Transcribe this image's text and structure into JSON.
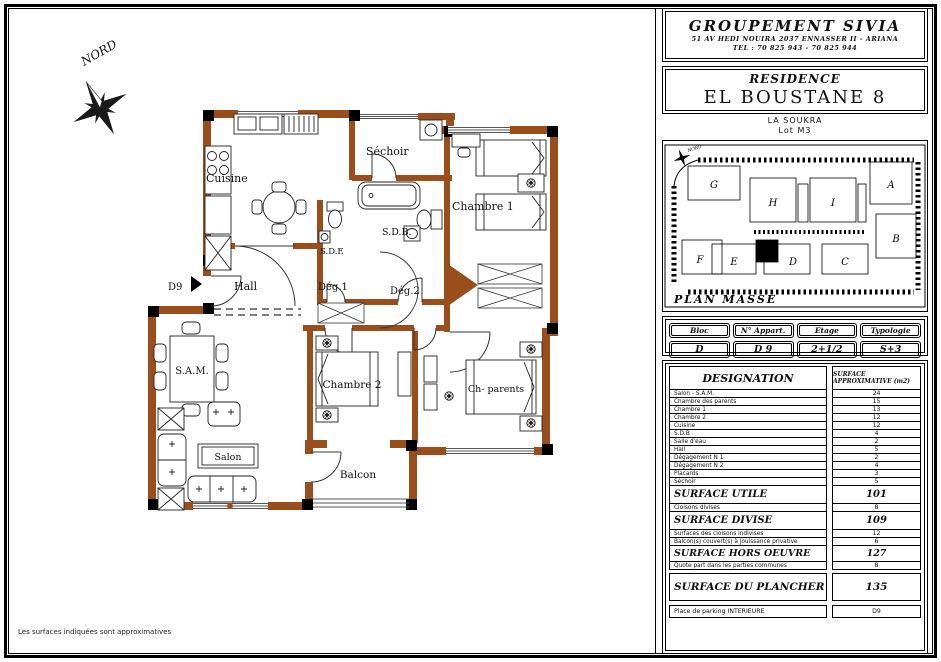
{
  "page": {
    "footer_note": "Les surfaces indiquées sont approximatives"
  },
  "company": {
    "name": "GROUPEMENT SIVIA",
    "address": "51 AV HEDI NOUIRA 2037 ENNASSER II - ARIANA",
    "tel": "TEL : 70 825 943 - 70 825 944"
  },
  "residence": {
    "label": "RESIDENCE",
    "name": "EL BOUSTANE 8",
    "location": "LA SOUKRA",
    "lot": "Lot M3"
  },
  "site_plan": {
    "title": "PLAN MASSE",
    "north": "NORD",
    "blocks": [
      "A",
      "B",
      "C",
      "D",
      "E",
      "F",
      "G",
      "H",
      "I"
    ]
  },
  "unit_info": {
    "headers": [
      "Bloc",
      "N° Appart.",
      "Etage",
      "Typologie"
    ],
    "values": [
      "D",
      "D 9",
      "2+1/2",
      "S+3"
    ]
  },
  "surface_table": {
    "header_designation": "DESIGNATION",
    "header_surface": "SURFACE APPROXIMATIVE (m2)",
    "rows": [
      {
        "label": "Salon - S.A.M.",
        "value": "24"
      },
      {
        "label": "Chambre des parents",
        "value": "15"
      },
      {
        "label": "Chambre 1",
        "value": "13"
      },
      {
        "label": "Chambre 2",
        "value": "12"
      },
      {
        "label": "Cuisine",
        "value": "12"
      },
      {
        "label": "S.D.B",
        "value": "4"
      },
      {
        "label": "Salle d'eau",
        "value": "2"
      },
      {
        "label": "Hall",
        "value": "5"
      },
      {
        "label": "Dégagement N 1",
        "value": "2"
      },
      {
        "label": "Dégagement N 2",
        "value": "4"
      },
      {
        "label": "Placards",
        "value": "3"
      },
      {
        "label": "Séchoir",
        "value": "5"
      }
    ],
    "sections": [
      {
        "label": "SURFACE UTILE",
        "value": "101"
      },
      {
        "label": "Cloisons divises",
        "value": "8"
      },
      {
        "label": "SURFACE DIVISE",
        "value": "109"
      },
      {
        "label": "Surfaces des cloisons indivises",
        "value": "12"
      },
      {
        "label": "Balcon(s) couvert(s) à jouissance privative",
        "value": "6"
      },
      {
        "label": "SURFACE HORS OEUVRE",
        "value": "127"
      },
      {
        "label": "Quote part dans les parties communes",
        "value": "8"
      },
      {
        "label": "SURFACE DU PLANCHER",
        "value": "135"
      },
      {
        "label": "Place de parking INTERIEURE",
        "value": "D9"
      }
    ]
  },
  "floor_plan": {
    "north": "NORD",
    "entrance": "D9",
    "rooms": {
      "cuisine": "Cuisine",
      "sechoir": "Séchoir",
      "chambre1": "Chambre 1",
      "sdb": "S.D.B.",
      "sde": "S.D.E",
      "hall": "Hall",
      "deg1": "Dég.1",
      "deg2": "Dég.2",
      "sam": "S.A.M.",
      "chambre2": "Chambre 2",
      "ch_parents": "Ch- parents",
      "salon": "Salon",
      "balcon": "Balcon"
    }
  },
  "colors": {
    "wall_brown": "#9a4e1c",
    "ink": "#111111"
  }
}
